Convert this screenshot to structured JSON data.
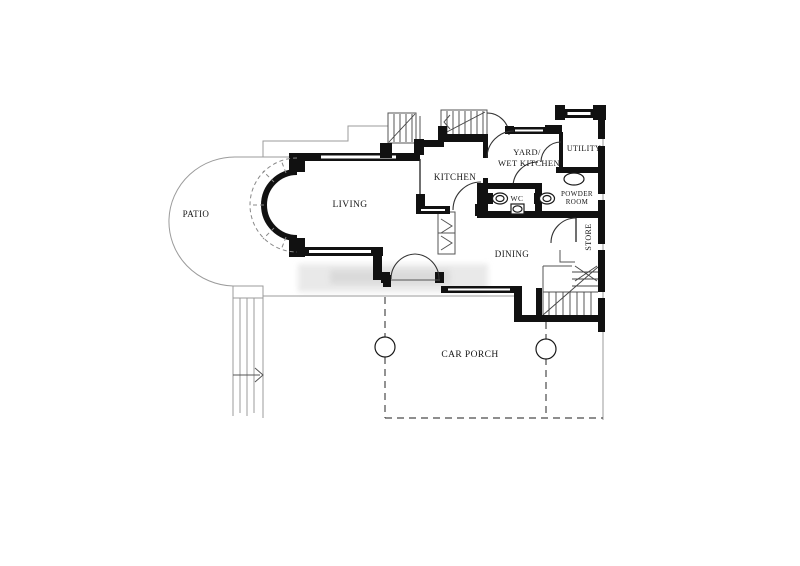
{
  "colors": {
    "background": "#ffffff",
    "walls": "#111111",
    "thin_lines": "#333333",
    "faint_lines": "#9b9b9b",
    "dashed_lines": "#4a4a4a",
    "watermark": "#d8d8d8"
  },
  "rooms": {
    "patio": {
      "label": "PATIO"
    },
    "living": {
      "label": "LIVING"
    },
    "kitchen": {
      "label": "KITCHEN"
    },
    "yard_wet_kitchen": {
      "line1": "YARD/",
      "line2": "WET KITCHEN"
    },
    "utility": {
      "label": "UTILITY"
    },
    "wc": {
      "label": "WC"
    },
    "powder_room": {
      "line1": "POWDER",
      "line2": "ROOM"
    },
    "store": {
      "label": "STORE"
    },
    "dining": {
      "label": "DINING"
    },
    "car_porch": {
      "label": "CAR PORCH"
    }
  },
  "symbols": {
    "columns": 2,
    "staircases": 3,
    "toilets": 2,
    "basins": 2,
    "bay_window": 1
  }
}
